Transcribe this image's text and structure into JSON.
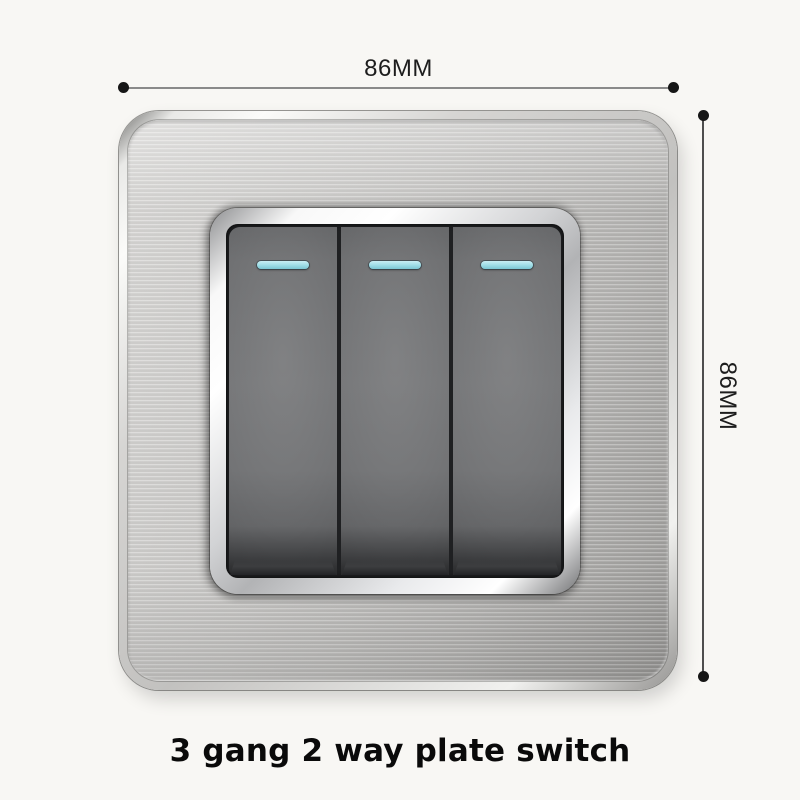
{
  "product": {
    "caption": "3 gang 2 way plate switch",
    "gang_count": 3
  },
  "dimensions": {
    "width_label": "86MM",
    "height_label": "86MM"
  },
  "switches": [
    {
      "name": "gang-1",
      "indicator": "cyan strip"
    },
    {
      "name": "gang-2",
      "indicator": "cyan strip"
    },
    {
      "name": "gang-3",
      "indicator": "cyan strip"
    }
  ],
  "colors": {
    "background": "#f8f7f4",
    "plate_silver": "#c2c1bf",
    "bezel_chrome": "#f0f0f0",
    "rocker_gray": "#717274",
    "indicator_cyan": "#9ddce6",
    "annotation_text": "#1d1d1d",
    "caption_text": "#0a0a0a"
  }
}
